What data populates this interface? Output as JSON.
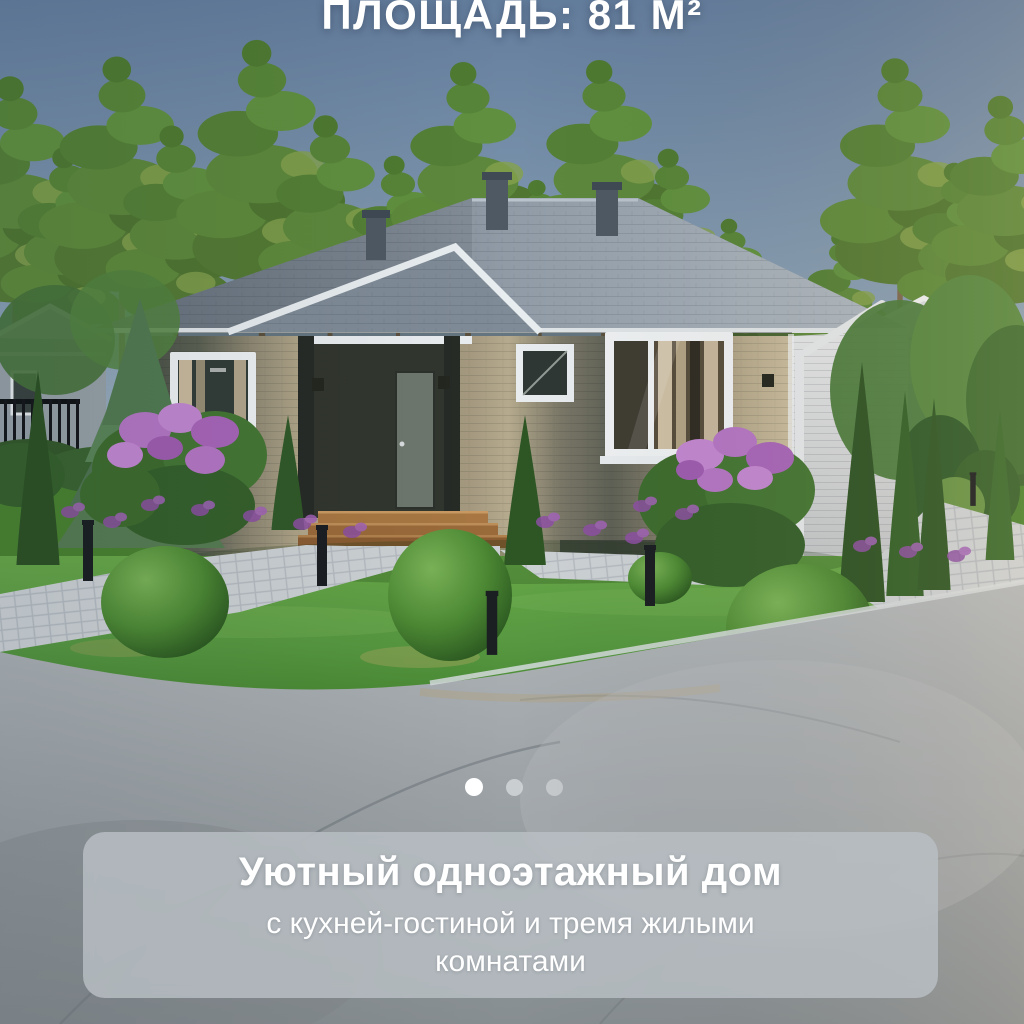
{
  "header": {
    "area_label": "ПЛОЩАДЬ: 81 М²"
  },
  "carousel": {
    "dot_count": 3,
    "active_index": 0
  },
  "caption_card": {
    "title": "Уютный одноэтажный дом",
    "subtitle": "с кухней-гостиной и тремя жилыми комнатами"
  },
  "colors": {
    "text": "#ffffff",
    "card_bg": "#b9c0c4d1",
    "dot_active": "#ffffff",
    "dot_inactive": "#eaeef0",
    "sky_top": "#637d9d",
    "sky_bottom": "#b6c4ce",
    "roof": "#8d98a4",
    "wall_light": "#b3a88d",
    "wall_dark": "#4f554b",
    "lawn": "#569740",
    "road": "#9da3a7",
    "foliage": "#4e7a31",
    "flowers": "#b476c4"
  }
}
